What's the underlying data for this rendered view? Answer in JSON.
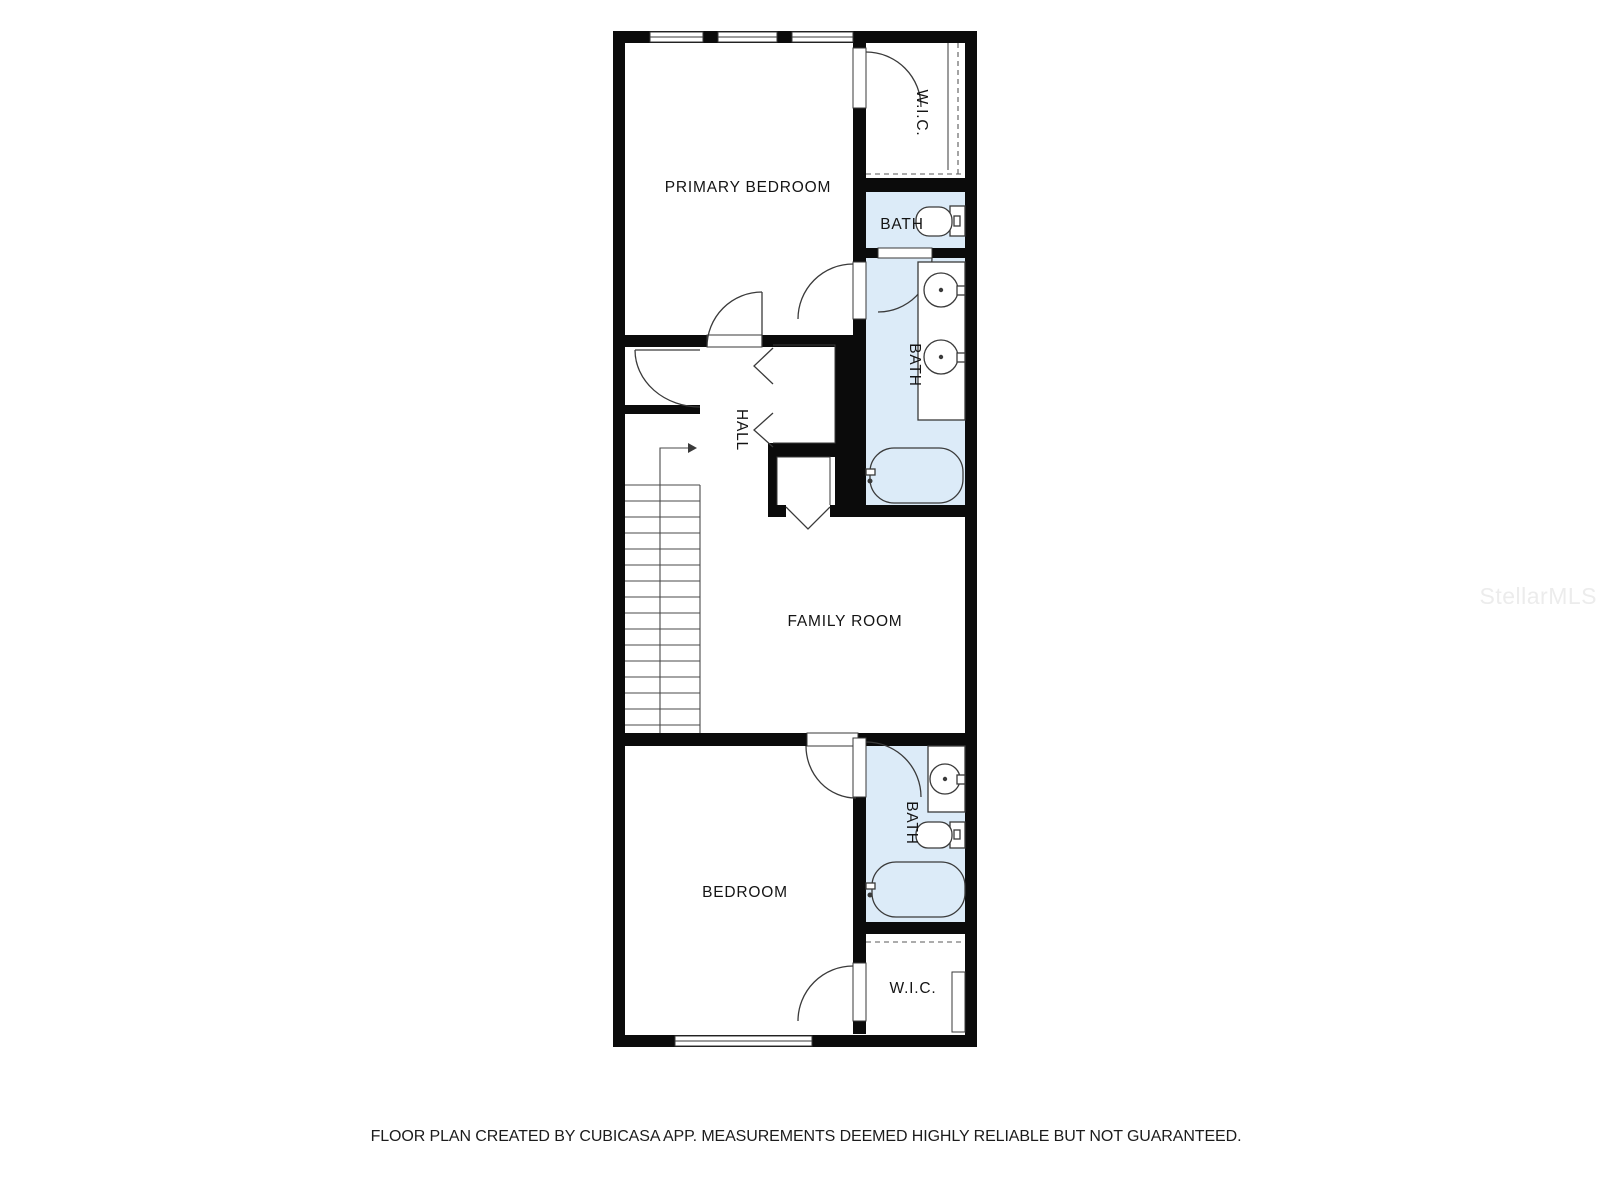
{
  "colors": {
    "wall": "#0b0b0b",
    "bath_fill": "#dcebf8",
    "fixture_line": "#3a3a3a",
    "label": "#141414",
    "watermark": "#ececec"
  },
  "rooms": {
    "primary_bedroom": {
      "label": "PRIMARY BEDROOM"
    },
    "wic_top": {
      "label": "W.I.C."
    },
    "bath_toilet": {
      "label": "BATH"
    },
    "bath_primary": {
      "label": "BATH"
    },
    "hall": {
      "label": "HALL"
    },
    "family_room": {
      "label": "FAMILY ROOM"
    },
    "bedroom": {
      "label": "BEDROOM"
    },
    "bath_lower": {
      "label": "BATH"
    },
    "wic_bottom": {
      "label": "W.I.C."
    }
  },
  "watermark": {
    "text": "StellarMLS"
  },
  "footer": {
    "text": "FLOOR PLAN CREATED BY CUBICASA APP. MEASUREMENTS DEEMED HIGHLY RELIABLE BUT NOT GUARANTEED."
  }
}
